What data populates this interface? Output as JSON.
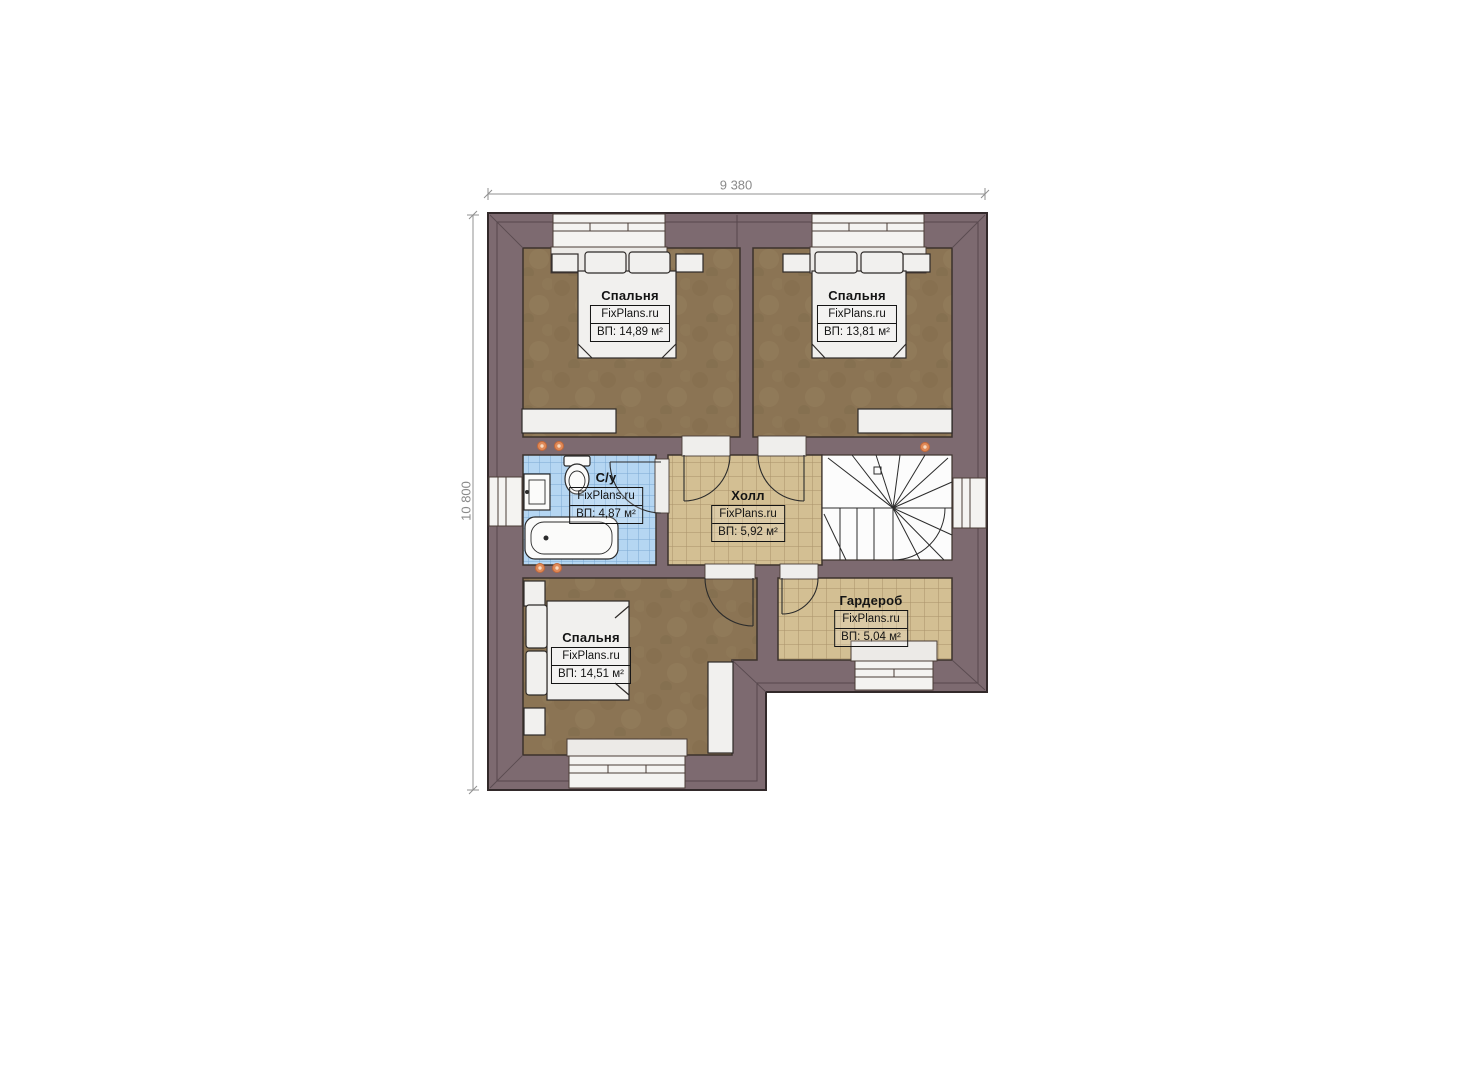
{
  "plan": {
    "dimensions": {
      "width": "9 380",
      "height": "10 800"
    },
    "rooms": [
      {
        "id": "bedroom-top-left",
        "name": "Спальня",
        "brand": "FixPlans.ru",
        "area": "ВП: 14,89 м²"
      },
      {
        "id": "bedroom-top-right",
        "name": "Спальня",
        "brand": "FixPlans.ru",
        "area": "ВП: 13,81 м²"
      },
      {
        "id": "bathroom",
        "name": "С/у",
        "brand": "FixPlans.ru",
        "area": "ВП: 4,87 м²"
      },
      {
        "id": "hall",
        "name": "Холл",
        "brand": "FixPlans.ru",
        "area": "ВП: 5,92 м²"
      },
      {
        "id": "wardrobe",
        "name": "Гардероб",
        "brand": "FixPlans.ru",
        "area": "ВП: 5,04 м²"
      },
      {
        "id": "bedroom-bottom",
        "name": "Спальня",
        "brand": "FixPlans.ru",
        "area": "ВП: 14,51 м²"
      }
    ],
    "colors": {
      "wall": "#7d6a70",
      "bedroom_floor": "#8b7454",
      "tile_floor": "#d3bf93",
      "bathroom_tile": "#b5d6f2",
      "stair_area": "#fcfcfc",
      "furniture": "#f1f0ee",
      "marker": "#e08a58",
      "dimension_text": "#8a8a8a"
    }
  }
}
